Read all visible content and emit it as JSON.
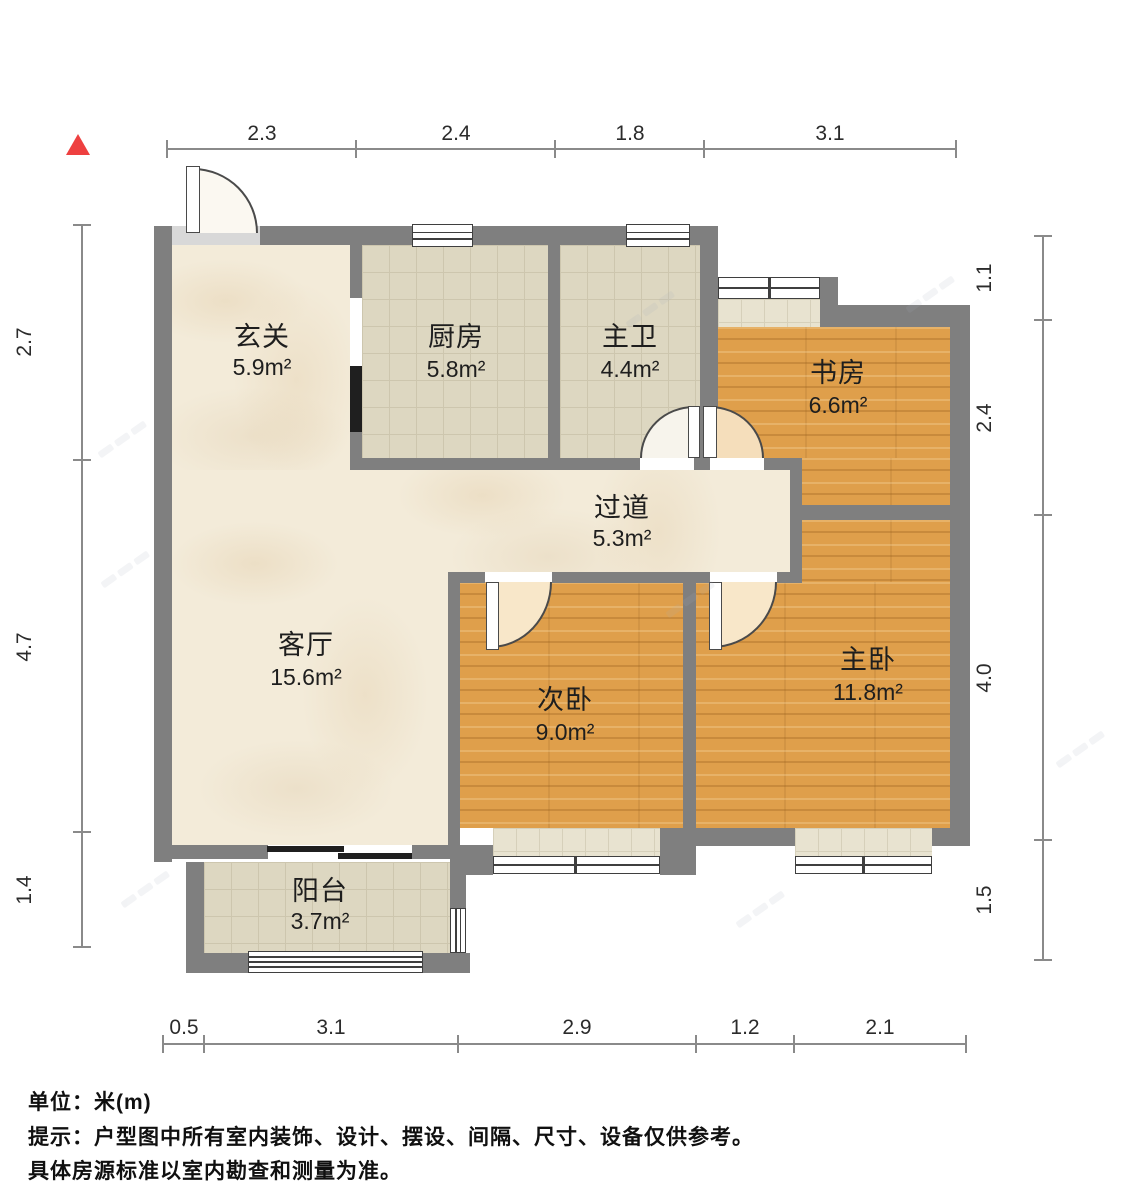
{
  "plan": {
    "unit_note": "单位：米(m)",
    "tip_line1": "提示：户型图中所有室内装饰、设计、摆设、间隔、尺寸、设备仅供参考。",
    "tip_line2": "具体房源标准以室内勘查和测量为准。"
  },
  "rooms": {
    "xuanguan": {
      "name": "玄关",
      "area": "5.9m²"
    },
    "chufang": {
      "name": "厨房",
      "area": "5.8m²"
    },
    "zhuwei": {
      "name": "主卫",
      "area": "4.4m²"
    },
    "shufang": {
      "name": "书房",
      "area": "6.6m²"
    },
    "guodao": {
      "name": "过道",
      "area": "5.3m²"
    },
    "keting": {
      "name": "客厅",
      "area": "15.6m²"
    },
    "ciwo": {
      "name": "次卧",
      "area": "9.0m²"
    },
    "zhuwo": {
      "name": "主卧",
      "area": "11.8m²"
    },
    "yangtai": {
      "name": "阳台",
      "area": "3.7m²"
    }
  },
  "dims": {
    "top": [
      "2.3",
      "2.4",
      "1.8",
      "3.1"
    ],
    "left": [
      "2.7",
      "4.7",
      "1.4"
    ],
    "right": [
      "1.1",
      "2.4",
      "4.0",
      "1.5"
    ],
    "bottom": [
      "0.5",
      "3.1",
      "2.9",
      "1.2",
      "2.1"
    ]
  },
  "colors": {
    "wall": "#7f7f7f",
    "wood_floor": "#df9f4b",
    "marble_floor": "#f3ebd9",
    "tile_floor": "#ddd7c1",
    "north_arrow": "#ee4040",
    "dim_line": "#8a8a8a"
  }
}
